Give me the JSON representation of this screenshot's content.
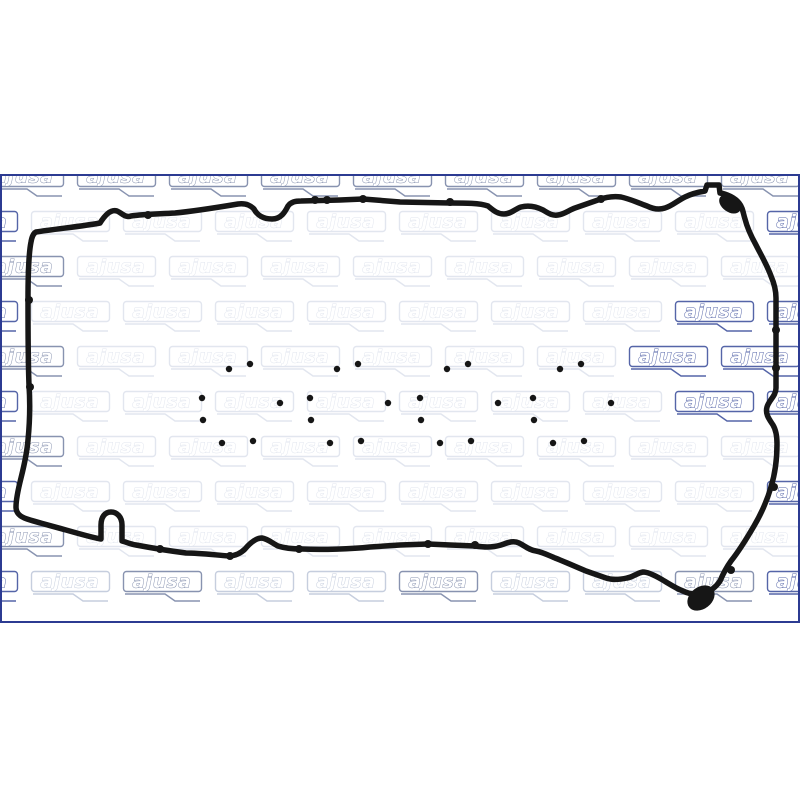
{
  "page": {
    "background": "#ffffff"
  },
  "product_image": {
    "description_name": "valve-cover-gasket-set-photo",
    "frame_color": "#2c3b92",
    "background": "#ffffff",
    "gasket_color": "#161616",
    "port_gasket_count": 4,
    "port_gasket_x": [
      195,
      303,
      413,
      526
    ],
    "port_gasket_y": 358,
    "watermark": {
      "text": "ajusa",
      "tones": {
        "faint": "#e2e6ef",
        "light": "#c6cede",
        "medium": "#8era-placeholder",
        "strong": "#5565a8"
      },
      "tone_colors": {
        "faint": "#e2e6ef",
        "light": "#c6cede",
        "medium": "#8893b0",
        "strong": "#5565a8"
      },
      "grid": {
        "x_pitch": 92,
        "y_pitch": 45,
        "row_offset_even": -15,
        "row_offset_odd": 31,
        "start_y": 166,
        "rows": 10,
        "tile_width": 80,
        "tile_height": 21
      },
      "medium_rows": [
        0
      ],
      "light_rows": [
        9
      ],
      "medium_tiles_in_light_row": [
        1,
        4,
        7
      ],
      "strong_tiles": [
        [
          3,
          7
        ],
        [
          4,
          7
        ],
        [
          4,
          8
        ],
        [
          5,
          7
        ]
      ],
      "left_sliver_rows_strong": true,
      "right_clipped_col_strong": true
    }
  }
}
